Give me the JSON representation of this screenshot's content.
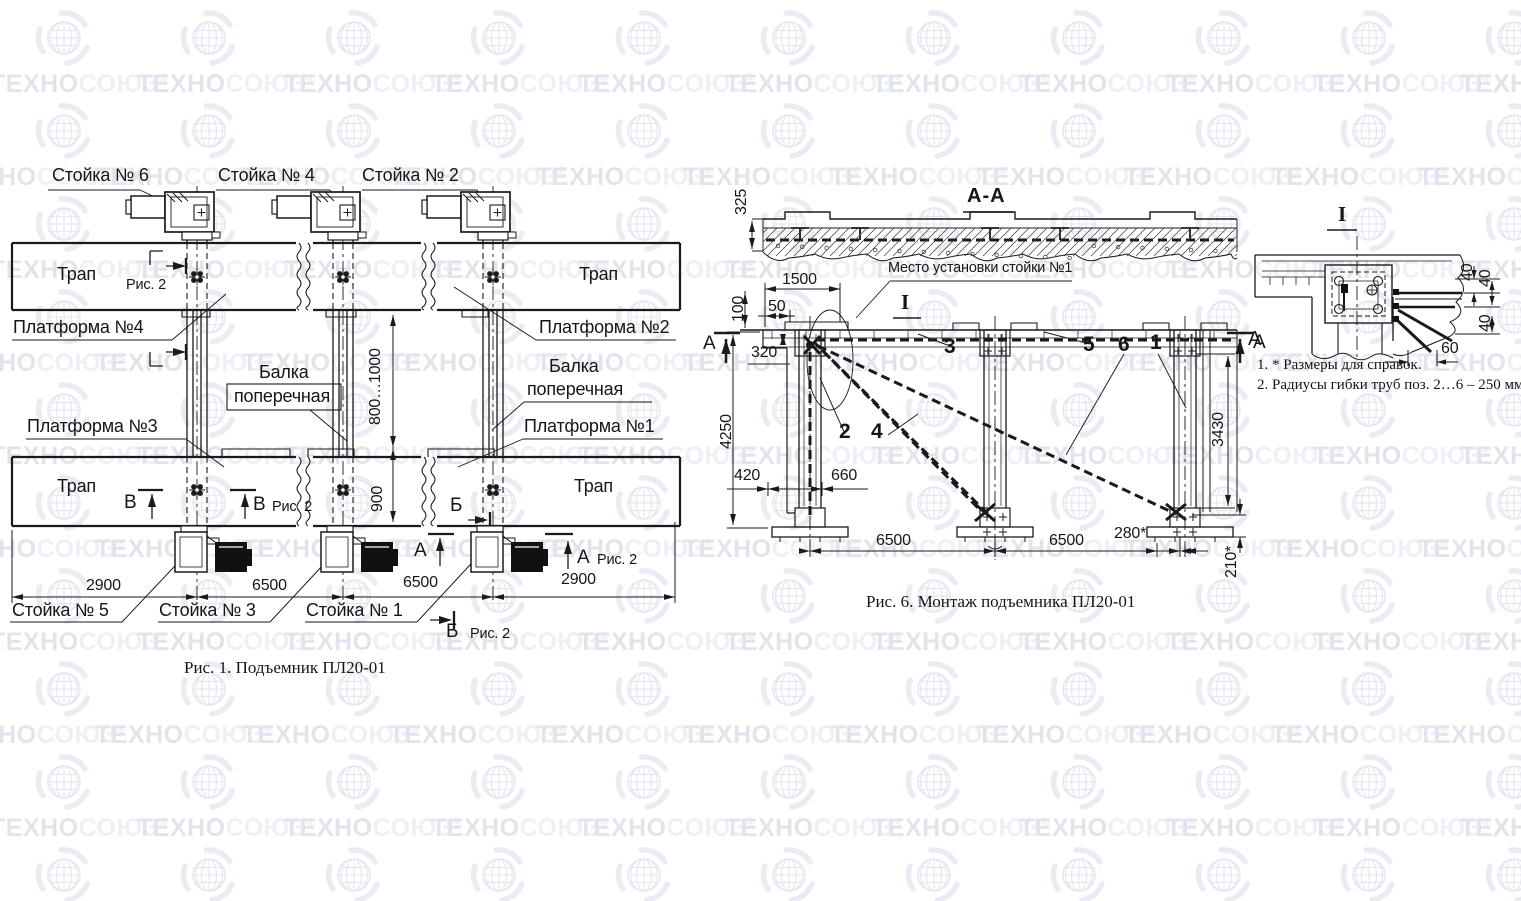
{
  "watermark": {
    "brand_dark": "ТЕХНО",
    "brand_light": "СОЮЗ",
    "reg": "®",
    "color_dark": "#e2e4ec",
    "color_light": "#eef0f7"
  },
  "colors": {
    "line": "#1a1a1a",
    "background": "#ffffff"
  },
  "fig1": {
    "caption": "Рис. 1. Подъемник ПЛ20-01",
    "stand6": "Стойка № 6",
    "stand4": "Стойка № 4",
    "stand2": "Стойка № 2",
    "stand5": "Стойка № 5",
    "stand3": "Стойка № 3",
    "stand1": "Стойка № 1",
    "trap": "Трап",
    "platform4": "Платформа №4",
    "platform2": "Платформа №2",
    "platform3": "Платформа №3",
    "platform1": "Платформа №1",
    "beam_word1": "Балка",
    "beam_word2": "поперечная",
    "fig_ref": "Рис. 2",
    "marker_v": "В",
    "marker_b": "Б",
    "marker_a": "А",
    "dim_2900": "2900",
    "dim_6500": "6500",
    "dim_height": "800…1000",
    "dim_900": "900"
  },
  "fig6": {
    "caption": "Рис. 6. Монтаж подъемника ПЛ20-01",
    "section": "А-А",
    "callout": "Место установки стойки №1",
    "view_marker": "I",
    "marker_a": "А",
    "parts": {
      "p1": "1",
      "p2": "2",
      "p3": "3",
      "p4": "4",
      "p5": "5",
      "p6": "6"
    },
    "dims": {
      "d325": "325",
      "d1500": "1500",
      "d100": "100",
      "d50": "50",
      "d320": "320",
      "d4250": "4250",
      "d420": "420",
      "d660": "660",
      "d6500": "6500",
      "d280": "280*",
      "d210": "210*",
      "d3430": "3430"
    }
  },
  "detail": {
    "view_marker": "I",
    "dim_40": "40",
    "dim_60": "60"
  },
  "notes": {
    "n1": "1. * Размеры для справок.",
    "n2": "2. Радиусы гибки труб поз. 2…6 – 250 мм."
  }
}
